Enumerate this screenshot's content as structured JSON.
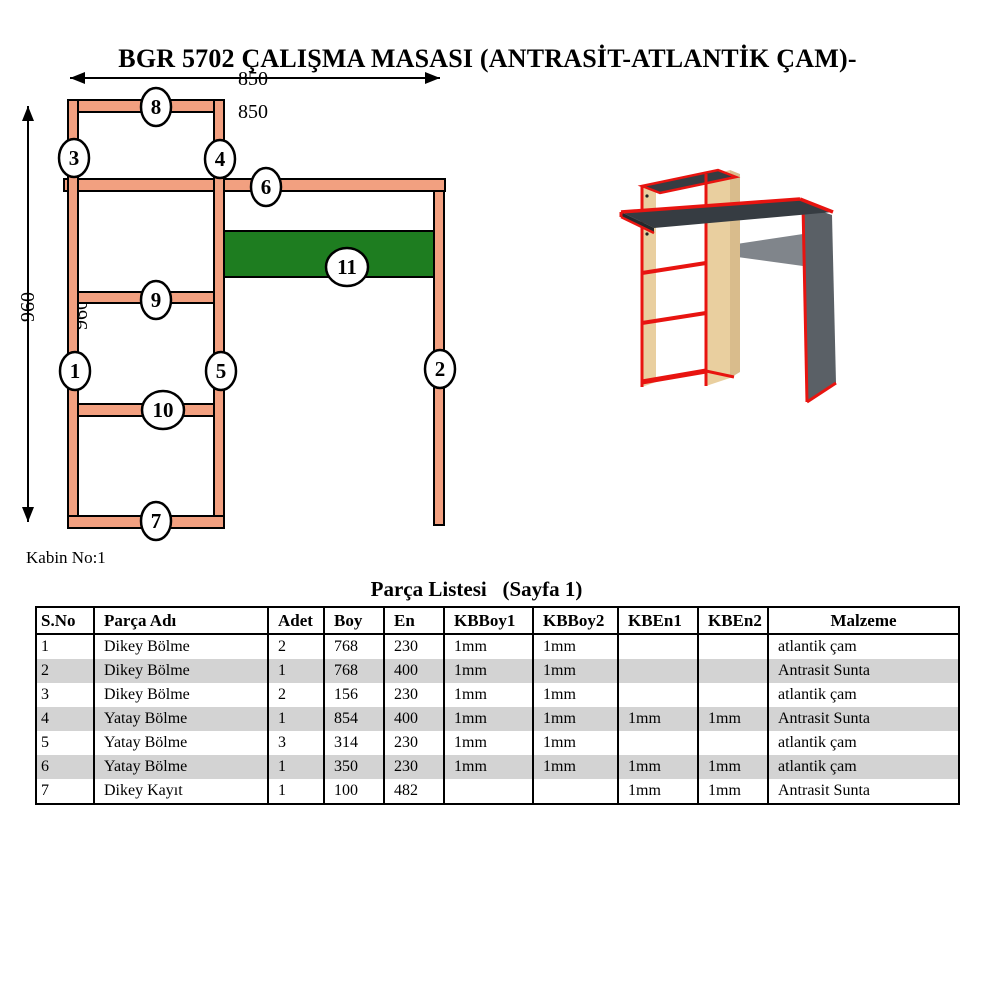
{
  "title": "BGR 5702 ÇALIŞMA MASASI (ANTRASİT-ATLANTİK ÇAM)-",
  "drawing": {
    "dim_width": "850",
    "width_label": "850",
    "dim_height": "960",
    "inner_height_label": "960",
    "cabin_note": "Kabin No:1",
    "markers": {
      "m1": "1",
      "m2": "2",
      "m3": "3",
      "m4": "4",
      "m5": "5",
      "m6": "6",
      "m7": "7",
      "m8": "8",
      "m9": "9",
      "m10": "10",
      "m11": "11"
    }
  },
  "colors": {
    "panel": "#F2A080",
    "green": "#1E7D20",
    "red": "#E81410",
    "wood": "#E9CF9F",
    "wood2": "#D9BC8C",
    "anth": "#363C42",
    "leg": "#5A6066",
    "rail": "#80858B",
    "row_shade": "#D3D3D3"
  },
  "table": {
    "title": "Parça Listesi   (Sayfa 1)",
    "headers": [
      "S.No",
      "Parça Adı",
      "Adet",
      "Boy",
      "En",
      "KBBoy1",
      "KBBoy2",
      "KBEn1",
      "KBEn2",
      "Malzeme"
    ],
    "col_widths": [
      58,
      174,
      56,
      60,
      60,
      89,
      85,
      80,
      70,
      191
    ],
    "rows": [
      [
        "1",
        "Dikey Bölme",
        "2",
        "768",
        "230",
        "1mm",
        "1mm",
        "",
        "",
        "atlantik çam"
      ],
      [
        "2",
        "Dikey Bölme",
        "1",
        "768",
        "400",
        "1mm",
        "1mm",
        "",
        "",
        "Antrasit Sunta"
      ],
      [
        "3",
        "Dikey Bölme",
        "2",
        "156",
        "230",
        "1mm",
        "1mm",
        "",
        "",
        "atlantik çam"
      ],
      [
        "4",
        "Yatay Bölme",
        "1",
        "854",
        "400",
        "1mm",
        "1mm",
        "1mm",
        "1mm",
        "Antrasit Sunta"
      ],
      [
        "5",
        "Yatay Bölme",
        "3",
        "314",
        "230",
        "1mm",
        "1mm",
        "",
        "",
        "atlantik çam"
      ],
      [
        "6",
        "Yatay Bölme",
        "1",
        "350",
        "230",
        "1mm",
        "1mm",
        "1mm",
        "1mm",
        "atlantik çam"
      ],
      [
        "7",
        "Dikey Kayıt",
        "1",
        "100",
        "482",
        "",
        "",
        "1mm",
        "1mm",
        "Antrasit Sunta"
      ]
    ]
  }
}
